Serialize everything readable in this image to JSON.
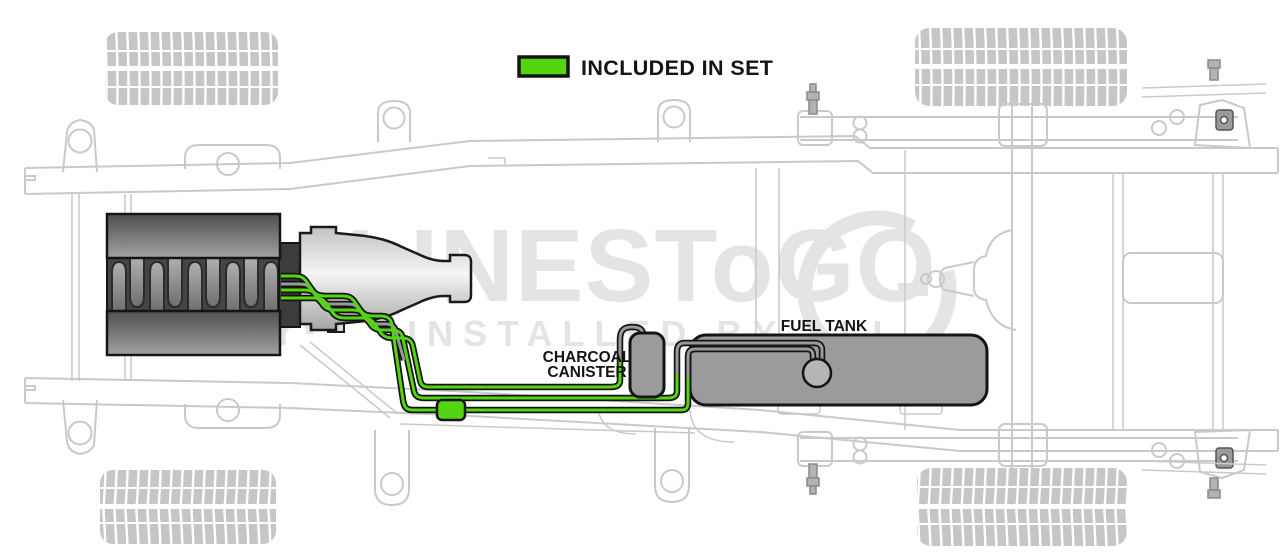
{
  "legend": {
    "label": "INCLUDED IN SET",
    "swatch_color": "#55d512"
  },
  "labels": {
    "charcoal_canister_line1": "CHARCOAL",
    "charcoal_canister_line2": "CANISTER",
    "fuel_tank": "FUEL TANK"
  },
  "watermark": {
    "line1": "LINESToGO",
    "line2": "INSTALLED BY ALL"
  },
  "colors": {
    "included_green": "#55d512",
    "excluded_line_gray": "#999999",
    "line_outline": "#141414",
    "component_fill": "#9b9b9b",
    "pump_fill": "#b5b5b5",
    "chassis_outline": "#c9c9c9",
    "watermark_gray": "#e4e4e4",
    "label_text": "#141414"
  },
  "parts": {
    "engine": "engine",
    "transmission": "transmission",
    "fuel_lines_included": "green fuel lines",
    "fuel_lines_excluded": "gray lines",
    "fuel_filter": "fuel filter",
    "fuel_pump": "fuel pump sender",
    "fuel_tank": "fuel tank",
    "charcoal_canister": "charcoal canister",
    "chassis": "truck frame with tires, springs, rear axle"
  }
}
